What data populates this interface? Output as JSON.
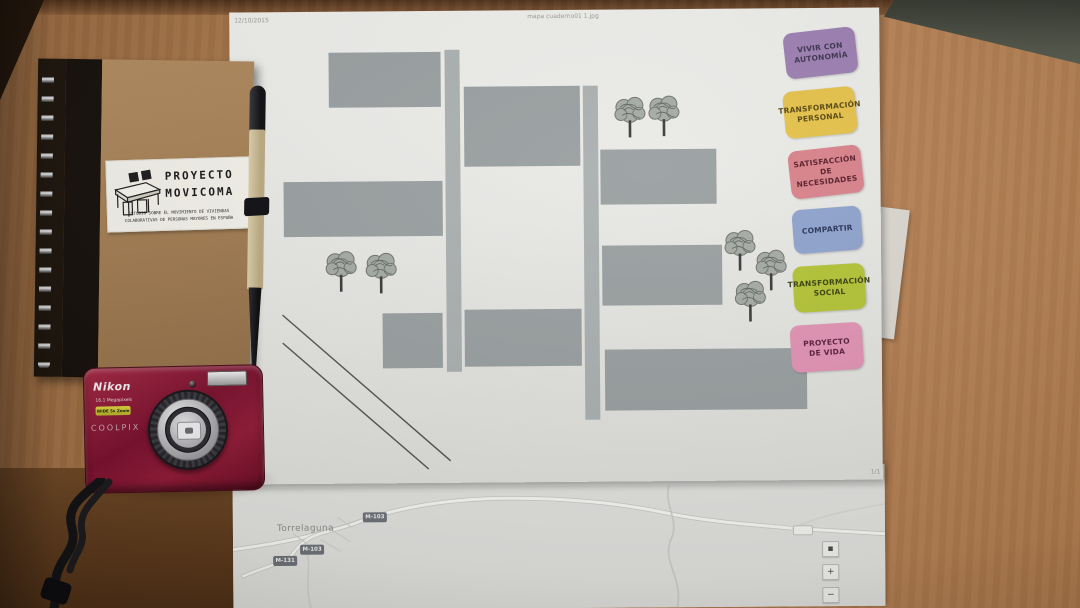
{
  "diagram_sheet": {
    "header_date": "12/10/2015",
    "header_filename": "mapa cuaderno01 1.jpg",
    "page_indicator": "1/1",
    "building_color": "#9aa0a1",
    "street_color": "#abb0b0",
    "sticky_labels": [
      {
        "lines": [
          "VIVIR CON",
          "AUTONOMÍA"
        ],
        "color": "#9c7fb2"
      },
      {
        "lines": [
          "TRANSFORMACIÓN",
          "PERSONAL"
        ],
        "color": "#e5c24b"
      },
      {
        "lines": [
          "SATISFACCIÓN DE",
          "NECESIDADES"
        ],
        "color": "#d9828b"
      },
      {
        "lines": [
          "COMPARTIR",
          ""
        ],
        "color": "#8fa3cd"
      },
      {
        "lines": [
          "TRANSFORMACIÓN",
          "SOCIAL"
        ],
        "color": "#b4c437"
      },
      {
        "lines": [
          "PROYECTO",
          "DE VIDA"
        ],
        "color": "#e293b4"
      }
    ]
  },
  "map_sheet": {
    "url_header": "https://drive.google.com/drive/folders/0B0JJrQbGwtcONbJ0RU2CYzRlTFk",
    "town_label": "Torrelaguna",
    "road_badges": [
      "M-103",
      "M-103",
      "M-131"
    ],
    "blank_badge": "",
    "map_controls": {
      "top_button": "▪",
      "zoom_in": "+",
      "zoom_out": "−"
    }
  },
  "notebook": {
    "cover_color": "#a47e53",
    "sticker": {
      "title_lines": [
        "PROYECTO",
        "MOVICOMA"
      ],
      "subtitle_lines": [
        "ESTUDIO SOBRE EL MOVIMIENTO DE VIVIENDAS",
        "COLABORATIVAS DE PERSONAS MAYORES EN ESPAÑA"
      ]
    }
  },
  "camera": {
    "brand": "Nikon",
    "megapixels_text": "16.1 Megapixels",
    "zoom_badge_text": "WIDE 5x Zoom",
    "model_text": "COOLPIX",
    "body_color": "#8c1b32"
  }
}
